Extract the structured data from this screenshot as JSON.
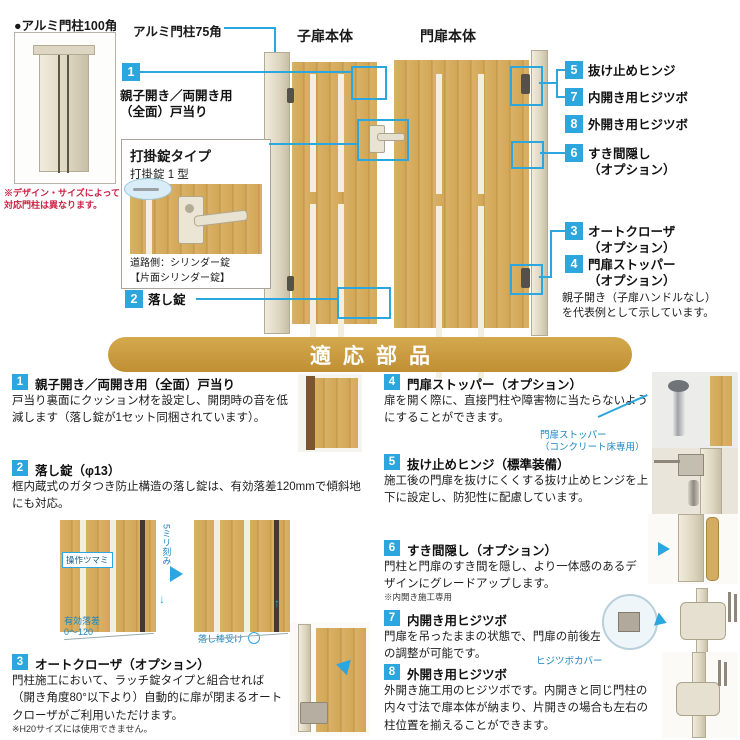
{
  "colors": {
    "accent_blue": "#2BA6DE",
    "banner_gold": "#C9973B",
    "wood_tan": "#D5A95C",
    "post_cream": "#E7E1D0",
    "note_red": "#CC2244"
  },
  "top": {
    "post_caption": "●アルミ門柱100角",
    "post_note": "※デザイン・サイズによって\n対応門柱は異なります。",
    "pillar75": "アルミ門柱75角",
    "child_door": "子扉本体",
    "main_door": "門扉本体",
    "c1_num": "1",
    "c1_label": "親子開き／両開き用\n（全面）戸当り",
    "lockbox": {
      "title": "打掛錠タイプ",
      "subtitle": "打掛錠 1 型",
      "caption": "道路側：シリンダー錠\n【片面シリンダー錠】"
    },
    "c2_num": "2",
    "c2_label": "落し錠",
    "rc": [
      {
        "n": "5",
        "t": "抜け止めヒンジ"
      },
      {
        "n": "7",
        "t": "内開き用ヒジツボ"
      },
      {
        "n": "8",
        "t": "外開き用ヒジツボ"
      },
      {
        "n": "6",
        "t": "すき間隠し\n（オプション）"
      },
      {
        "n": "3",
        "t": "オートクローザ\n（オプション）"
      },
      {
        "n": "4",
        "t": "門扉ストッパー\n（オプション）"
      }
    ],
    "note": "親子開き（子扉ハンドルなし）\nを代表例として示しています。"
  },
  "banner": {
    "title": "適応部品"
  },
  "sections": [
    {
      "num": "1",
      "title": "親子開き／両開き用（全面）戸当り",
      "body": "戸当り裏面にクッション材を設定し、開閉時の音を低減します（落し錠が1セット同梱されています）。"
    },
    {
      "num": "2",
      "title": "落し錠（φ13）",
      "body": "框内蔵式のガタつき防止構造の落し錠は、有効落差120mmで傾斜地にも対応。",
      "labels": {
        "knob": "操作ツマミ",
        "step": "5ミリ刻み",
        "drop": "有効落差\n0〜120",
        "receiver": "落し棒受け"
      }
    },
    {
      "num": "3",
      "title": "オートクローザ（オプション）",
      "body": "門柱施工において、ラッチ錠タイプと組合せれば（開き角度80°以下より）自動的に扉が閉まるオートクローザがご利用いただけます。",
      "note": "※H20サイズには使用できません。"
    },
    {
      "num": "4",
      "title": "門扉ストッパー（オプション）",
      "body": "扉を開く際に、直接門柱や障害物に当たらないようにすることができます。",
      "label": "門扉ストッパー\n（コンクリート床専用）"
    },
    {
      "num": "5",
      "title": "抜け止めヒンジ（標準装備）",
      "body": "施工後の門扉を抜けにくくする抜け止めヒンジを上下に設定し、防犯性に配慮しています。"
    },
    {
      "num": "6",
      "title": "すき間隠し（オプション）",
      "body": "門柱と門扉のすき間を隠し、より一体感のあるデザインにグレードアップします。",
      "note": "※内開き施工専用"
    },
    {
      "num": "7",
      "title": "内開き用ヒジツボ",
      "body": "門扉を吊ったままの状態で、門扉の前後左右の調整が可能です。",
      "label": "ヒジツボカバー"
    },
    {
      "num": "8",
      "title": "外開き用ヒジツボ",
      "body": "外開き施工用のヒジツボです。内開きと同じ門柱の内々寸法で扉本体が納まり、片開きの場合も左右の柱位置を揃えることができます。"
    }
  ]
}
